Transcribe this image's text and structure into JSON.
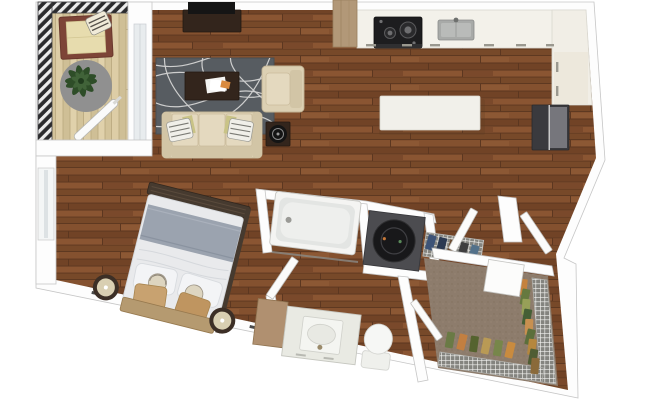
{
  "unit": {
    "type": "studio-apartment-3d-floor-plan-top-view",
    "rooms": [
      {
        "name": "balcony",
        "floor": "light-wood-planks",
        "edge": "hatched-metal-railing",
        "furniture": [
          "lounge-chair",
          "striped-pillow",
          "round-gray-rug",
          "potted-plant",
          "closed-umbrella"
        ]
      },
      {
        "name": "living-room",
        "floor": "dark-wood-planks",
        "furniture": [
          "tv-console",
          "flat-tv",
          "patterned-area-rug",
          "coffee-table",
          "papers",
          "armchair",
          "three-seat-sofa",
          "throw-pillows",
          "side-table",
          "round-speaker"
        ]
      },
      {
        "name": "kitchen",
        "floor": "dark-wood-planks",
        "furniture": [
          "l-shaped-counter",
          "two-burner-cooktop",
          "double-sink",
          "refrigerator",
          "white-island",
          "wood-column",
          "cabinet-handles"
        ]
      },
      {
        "name": "bedroom-area",
        "floor": "dark-wood-planks",
        "furniture": [
          "double-bed",
          "wood-headboard",
          "dark-foot-bench",
          "gray-folded-blanket",
          "white-pillows",
          "tan-accent-pillows",
          "round-nightstand-left",
          "round-nightstand-right",
          "window",
          "baseboard-vents"
        ]
      },
      {
        "name": "bathroom",
        "floor": "dark-wood-planks",
        "furniture": [
          "bathtub",
          "shower-rod",
          "vanity-with-sink",
          "wood-side-counter",
          "toilet",
          "open-door"
        ]
      },
      {
        "name": "laundry-nook",
        "floor": "dark-wood-planks",
        "furniture": [
          "front-load-washer",
          "wire-shelf",
          "supplies"
        ]
      },
      {
        "name": "walk-in-closet",
        "floor": "carpet",
        "furniture": [
          "wire-shelving-right",
          "wire-shelving-bottom",
          "hanging-clothes",
          "open-door-panel",
          "swing-door"
        ]
      },
      {
        "name": "entry",
        "furniture": [
          "entry-door",
          "hall-door",
          "wall-stub"
        ]
      }
    ]
  },
  "colors": {
    "background": "#ffffff",
    "wall": "#fdfdfd",
    "wall_outline": "#c6c6c6",
    "wood_floor": "#7c4a2b",
    "wood_seam": "#5c3720",
    "balcony_floor": "#d8c8a0",
    "railing": "#2b2b2d",
    "chair_frame": "#7d4437",
    "chair_cushion": "#e7dcae",
    "balcony_rug": "#909090",
    "plant": "#2e4d28",
    "rug": "#575c61",
    "rug_line": "#e3e3e1",
    "sofa": "#dcd0b3",
    "cushion": "#e4d9bf",
    "dark_furniture": "#33251c",
    "tv": "#151515",
    "counter": "#f3f1ea",
    "island": "#f1f0ea",
    "stove": "#1d1d1f",
    "sink": "#a8aaa8",
    "fridge": "#3a3a3e",
    "wood_column": "#b29878",
    "bed_duvet": "#e9eaec",
    "bed_blanket": "#9ba3af",
    "pillow_white": "#f3f4f6",
    "pillow_tan": "#c8a270",
    "footboard_dark": "#463a2f",
    "headboard_wood": "#b59a70",
    "nightstand": "#3c2f26",
    "nightstand_top": "#d9cfb2",
    "tub": "#f4f4f2",
    "tub_inner": "#e3e5e3",
    "washer_housing": "#4c4c50",
    "washer_door": "#18181a",
    "vanity": "#e9eae3",
    "vanity_wood": "#b09070",
    "toilet": "#f6f7f5",
    "closet_carpet": "#8d7c6c",
    "wire_shelf": "#84847f",
    "clothes_orange": "#c5823e",
    "clothes_green": "#66793f",
    "clothes_olive": "#55632f",
    "clothes_tan": "#b99a55",
    "clothes_navy": "#3d5377"
  }
}
